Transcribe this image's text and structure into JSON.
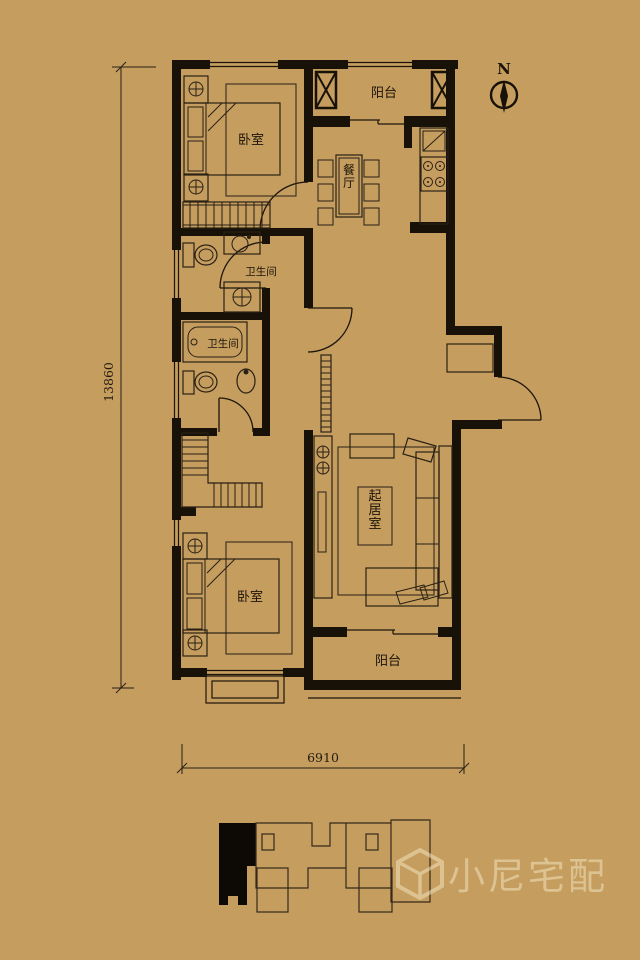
{
  "plan": {
    "room_labels": {
      "bedroom_top": "卧室",
      "balcony_top": "阳台",
      "dining": "餐厅",
      "bathroom_upper": "卫生间",
      "bathroom_lower": "卫生间",
      "living": "起居室",
      "bedroom_bottom": "卧室",
      "balcony_bottom": "阳台"
    },
    "dimensions": {
      "vertical": "13860",
      "horizontal": "6910"
    },
    "compass_north": "N",
    "watermark": "小尼宅配",
    "colors": {
      "background": "#c49d5f",
      "wall": "#181108",
      "furniture_line": "#2a2014",
      "watermark": "#f2e3bd"
    }
  }
}
